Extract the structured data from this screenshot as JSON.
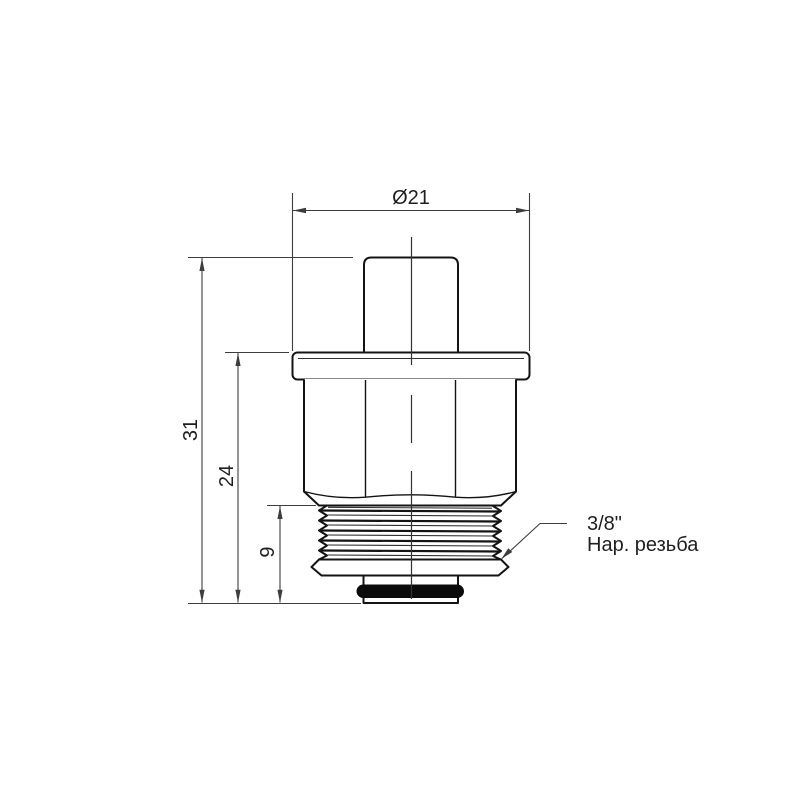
{
  "drawing": {
    "dimensions": {
      "diameter": "Ø21",
      "overall_height": "31",
      "body_height": "24",
      "thread_length": "9"
    },
    "thread_note": {
      "line1": "3/8\"",
      "line2": "Нар. резьба"
    },
    "colors": {
      "outline": "#141414",
      "dimension": "#3d3d3d",
      "oring": "#0b0b0b",
      "background": "#ffffff"
    }
  }
}
